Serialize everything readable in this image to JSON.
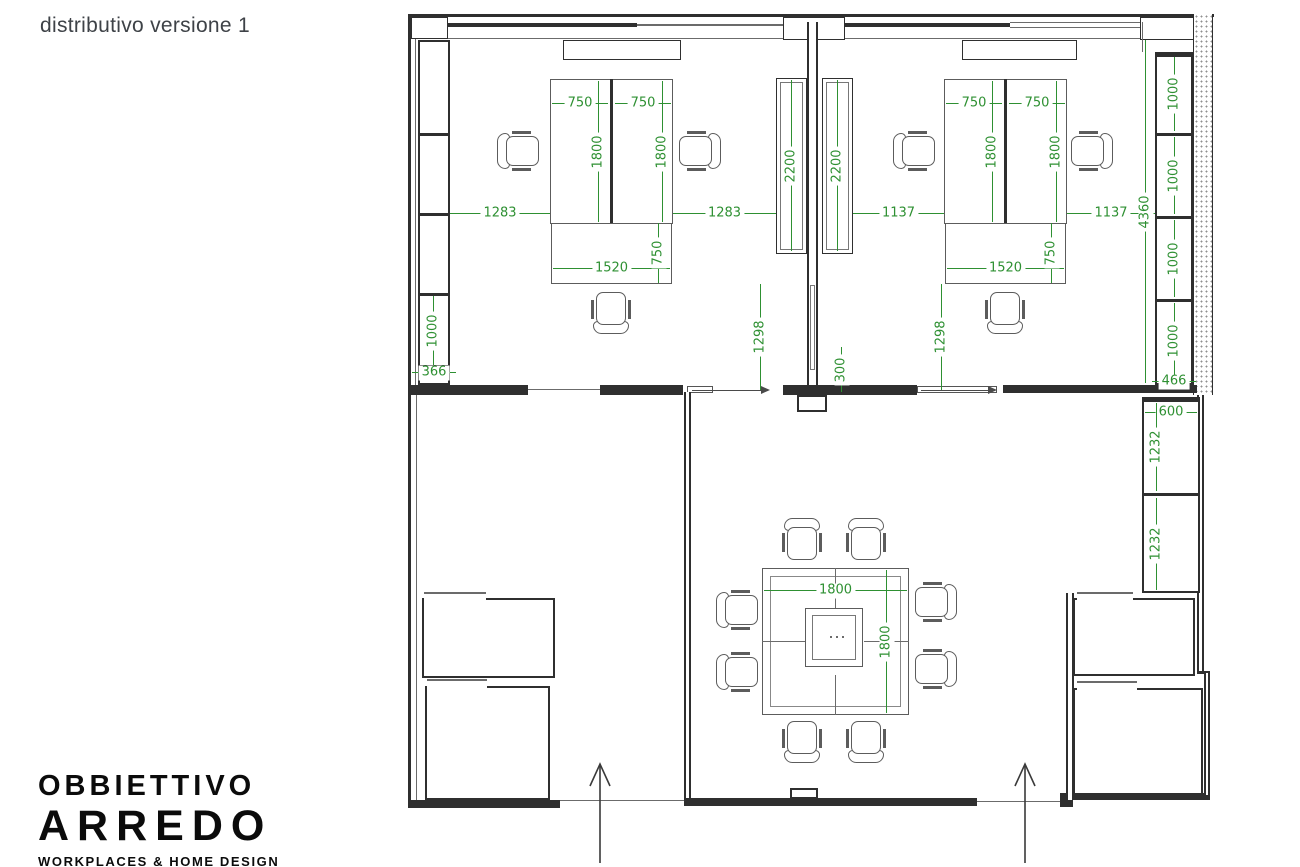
{
  "title": "distributivo versione 1",
  "logo": {
    "line1": "OBBIETTIVO",
    "line2": "ARREDO",
    "tagline": "WORKPLACES & HOME DESIGN"
  },
  "colors": {
    "dimension_green": "#2e9032",
    "wall_dark": "#2f2f2f",
    "furniture_gray": "#5c5c5c"
  },
  "dims": {
    "left_office": {
      "desk_w1": "750",
      "desk_w2": "750",
      "desk_d1": "1800",
      "desk_d2": "1800",
      "gap_left": "1283",
      "gap_right": "1283",
      "wardrobe_a": "2200",
      "wardrobe_b": "2200",
      "return_w": "1520",
      "return_d": "750",
      "walkway": "1298",
      "cabinet_seg": "1000",
      "cabinet_w": "366"
    },
    "partition": {
      "gap": "300"
    },
    "right_office": {
      "desk_w1": "750",
      "desk_w2": "750",
      "desk_d1": "1800",
      "desk_d2": "1800",
      "gap_left": "1137",
      "gap_right": "1137",
      "return_w": "1520",
      "return_d": "750",
      "walkway": "1298",
      "wall_len": "4360",
      "cab_seg1": "1000",
      "cab_seg2": "1000",
      "cab_seg3": "1000",
      "cab_seg4": "1000",
      "cab_w": "466"
    },
    "storage": {
      "cab_w": "600",
      "cab_seg1": "1232",
      "cab_seg2": "1232"
    },
    "meeting": {
      "table_w": "1800",
      "table_d": "1800"
    }
  }
}
